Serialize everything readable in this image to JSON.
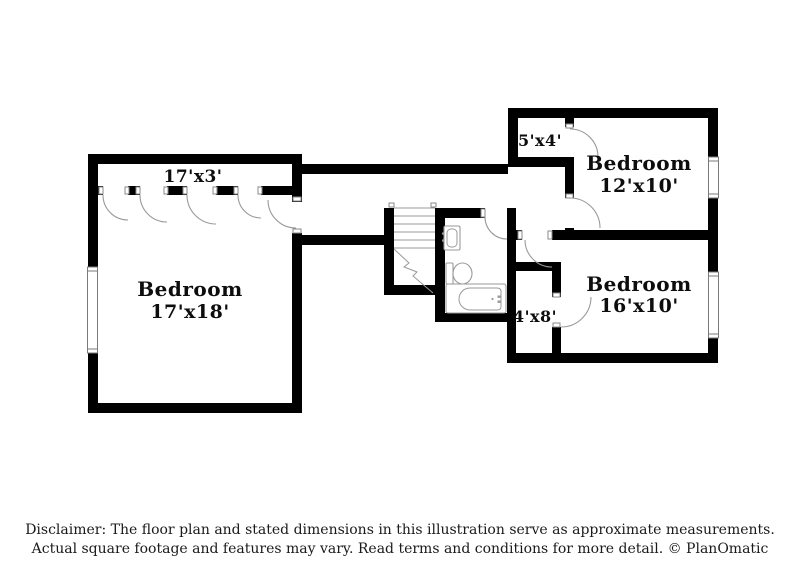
{
  "rooms": {
    "closet_strip": {
      "label": "17'x3'"
    },
    "bedroom_left": {
      "name": "Bedroom",
      "dims": "17'x18'"
    },
    "closet_small": {
      "label": "5'x4'"
    },
    "bedroom_top_right": {
      "name": "Bedroom",
      "dims": "12'x10'"
    },
    "bedroom_bottom_right": {
      "name": "Bedroom",
      "dims": "16'x10'"
    },
    "closet_bath": {
      "label": "4'x8'"
    }
  },
  "fixtures": {
    "stairs": "stairs-with-break-line",
    "sink": "wall-mounted-sink",
    "toilet": "toilet",
    "bathtub": "bathtub"
  },
  "footer": {
    "line1": "Disclaimer: The floor plan and stated dimensions in this illustration serve as approximate measurements.",
    "line2": "Actual square footage and features may vary. Read terms and conditions for more detail. © PlanOmatic"
  },
  "colors": {
    "wall": "#000000",
    "background": "#ffffff",
    "fixture_outline": "#9a9a9a"
  }
}
